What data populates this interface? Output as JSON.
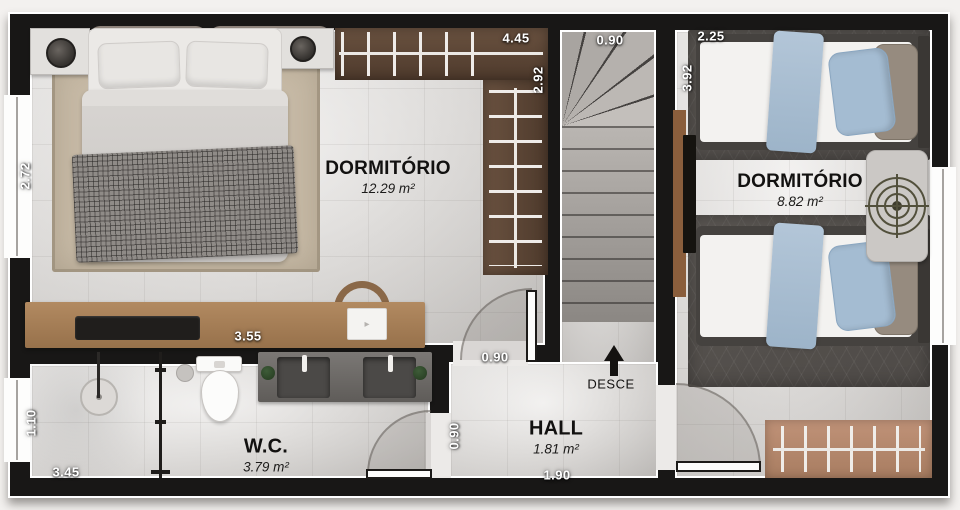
{
  "rooms": {
    "bedroom1": {
      "name": "DORMITÓRIO",
      "area": "12.29 m²"
    },
    "bedroom2": {
      "name": "DORMITÓRIO",
      "area": "8.82 m²"
    },
    "wc": {
      "name": "W.C.",
      "area": "3.79 m²"
    },
    "hall": {
      "name": "HALL",
      "area": "1.81 m²"
    }
  },
  "stairs": {
    "direction_label": "DESCE"
  },
  "dimensions": {
    "closet_width": "4.45",
    "closet_side": "2.92",
    "stairs_width": "0.90",
    "bedroom2_width": "2.25",
    "bedroom2_length": "3.92",
    "bedroom1_side": "2.72",
    "desk_length": "3.55",
    "bedroom1_door": "0.90",
    "wc_door": "0.90",
    "wc_side": "1.10",
    "wc_length": "3.45",
    "hall_length": "1.90"
  },
  "colors": {
    "wall": "#181716",
    "floor": "#e5e2df",
    "closet_dark": "#5a4334",
    "closet_light": "#b78a6f",
    "desk_wood": "#a98059",
    "rug_beige": "#c7baa6",
    "rug_dark": "#55514d",
    "accent_blue": "#a7bcd0"
  }
}
